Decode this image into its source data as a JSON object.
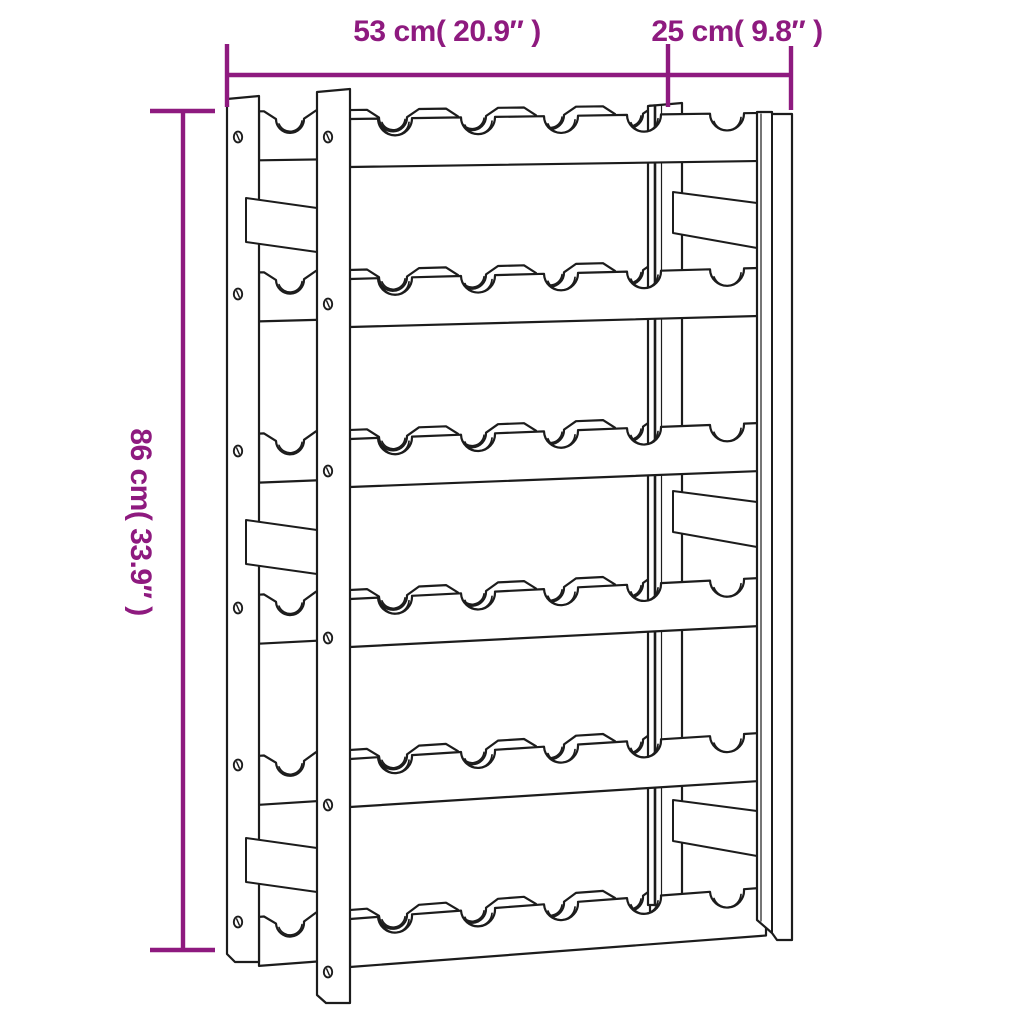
{
  "figure": {
    "name": "wine-rack-technical-line-drawing",
    "rows": 6,
    "bottle_notches_per_row": 5
  },
  "dimensions": {
    "width": {
      "label": "53 cm( 20.9″ )"
    },
    "depth": {
      "label": "25 cm( 9.8″ )"
    },
    "height": {
      "label": "86 cm( 33.9″ )"
    }
  },
  "colors": {
    "dimension_annotation": "#8e1a7f",
    "line_art": "#1c1c1c",
    "background": "#ffffff"
  }
}
